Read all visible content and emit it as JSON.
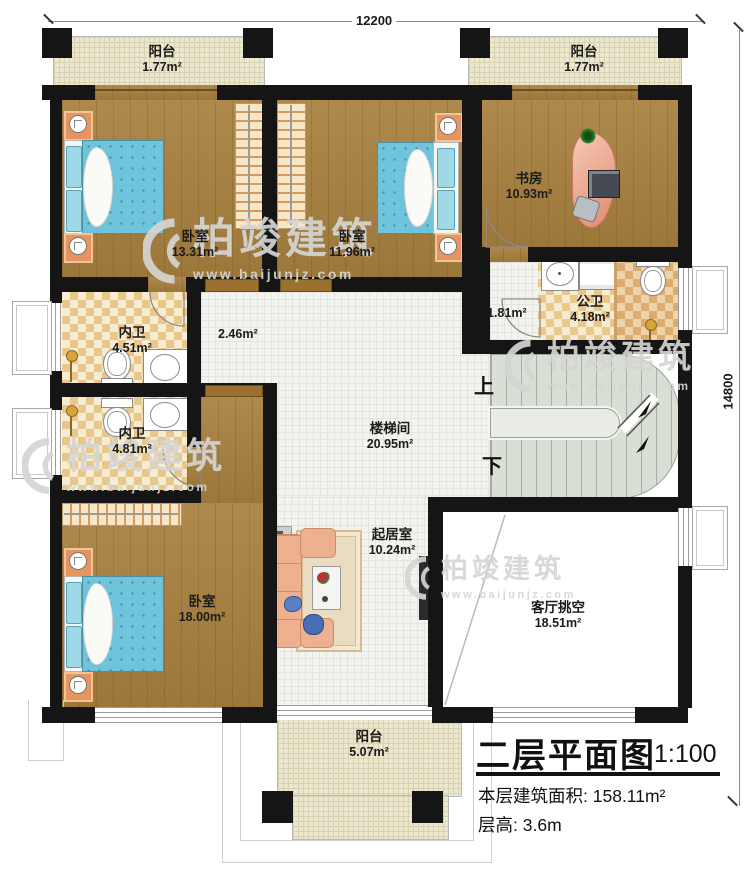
{
  "title_block": {
    "title": "二层平面图",
    "scale": "1:100",
    "area_label": "本层建筑面积:",
    "area_value": "158.11m²",
    "height_label": "层高:",
    "height_value": "3.6m"
  },
  "dimensions": {
    "top": "12200",
    "right": "14800"
  },
  "stairs": {
    "up": "上",
    "down": "下"
  },
  "watermark": {
    "brand": "柏竣建筑",
    "url": "www.baijunjz.com"
  },
  "rooms": {
    "balcony_tl": {
      "name": "阳台",
      "area": "1.77m²"
    },
    "balcony_tr": {
      "name": "阳台",
      "area": "1.77m²"
    },
    "bedroom1": {
      "name": "卧室",
      "area": "13.31m²"
    },
    "bedroom2": {
      "name": "卧室",
      "area": "11.96m²"
    },
    "study": {
      "name": "书房",
      "area": "10.93m²"
    },
    "public_bath": {
      "name": "公卫",
      "area": "4.18m²"
    },
    "vestibule": {
      "area": "1.81m²"
    },
    "corridor": {
      "area": "2.46m²"
    },
    "inner_bath1": {
      "name": "内卫",
      "area": "4.51m²"
    },
    "inner_bath2": {
      "name": "内卫",
      "area": "4.81m²"
    },
    "stairwell": {
      "name": "楼梯间",
      "area": "20.95m²"
    },
    "living": {
      "name": "起居室",
      "area": "10.24m²"
    },
    "bedroom3": {
      "name": "卧室",
      "area": "18.00m²"
    },
    "void": {
      "name": "客厅挑空",
      "area": "18.51m²"
    },
    "balcony_b": {
      "name": "阳台",
      "area": "5.07m²"
    }
  },
  "colors": {
    "wall": "#151515",
    "wood": "#a8803f",
    "tile": "#f3f3ef",
    "checker": "#e9c689",
    "balcony": "#ece7cf",
    "mattress": "#6fc3da",
    "pillow": "#9fd9e6",
    "stair": "#d9dfd4",
    "accent_orange": "#e8945f"
  }
}
